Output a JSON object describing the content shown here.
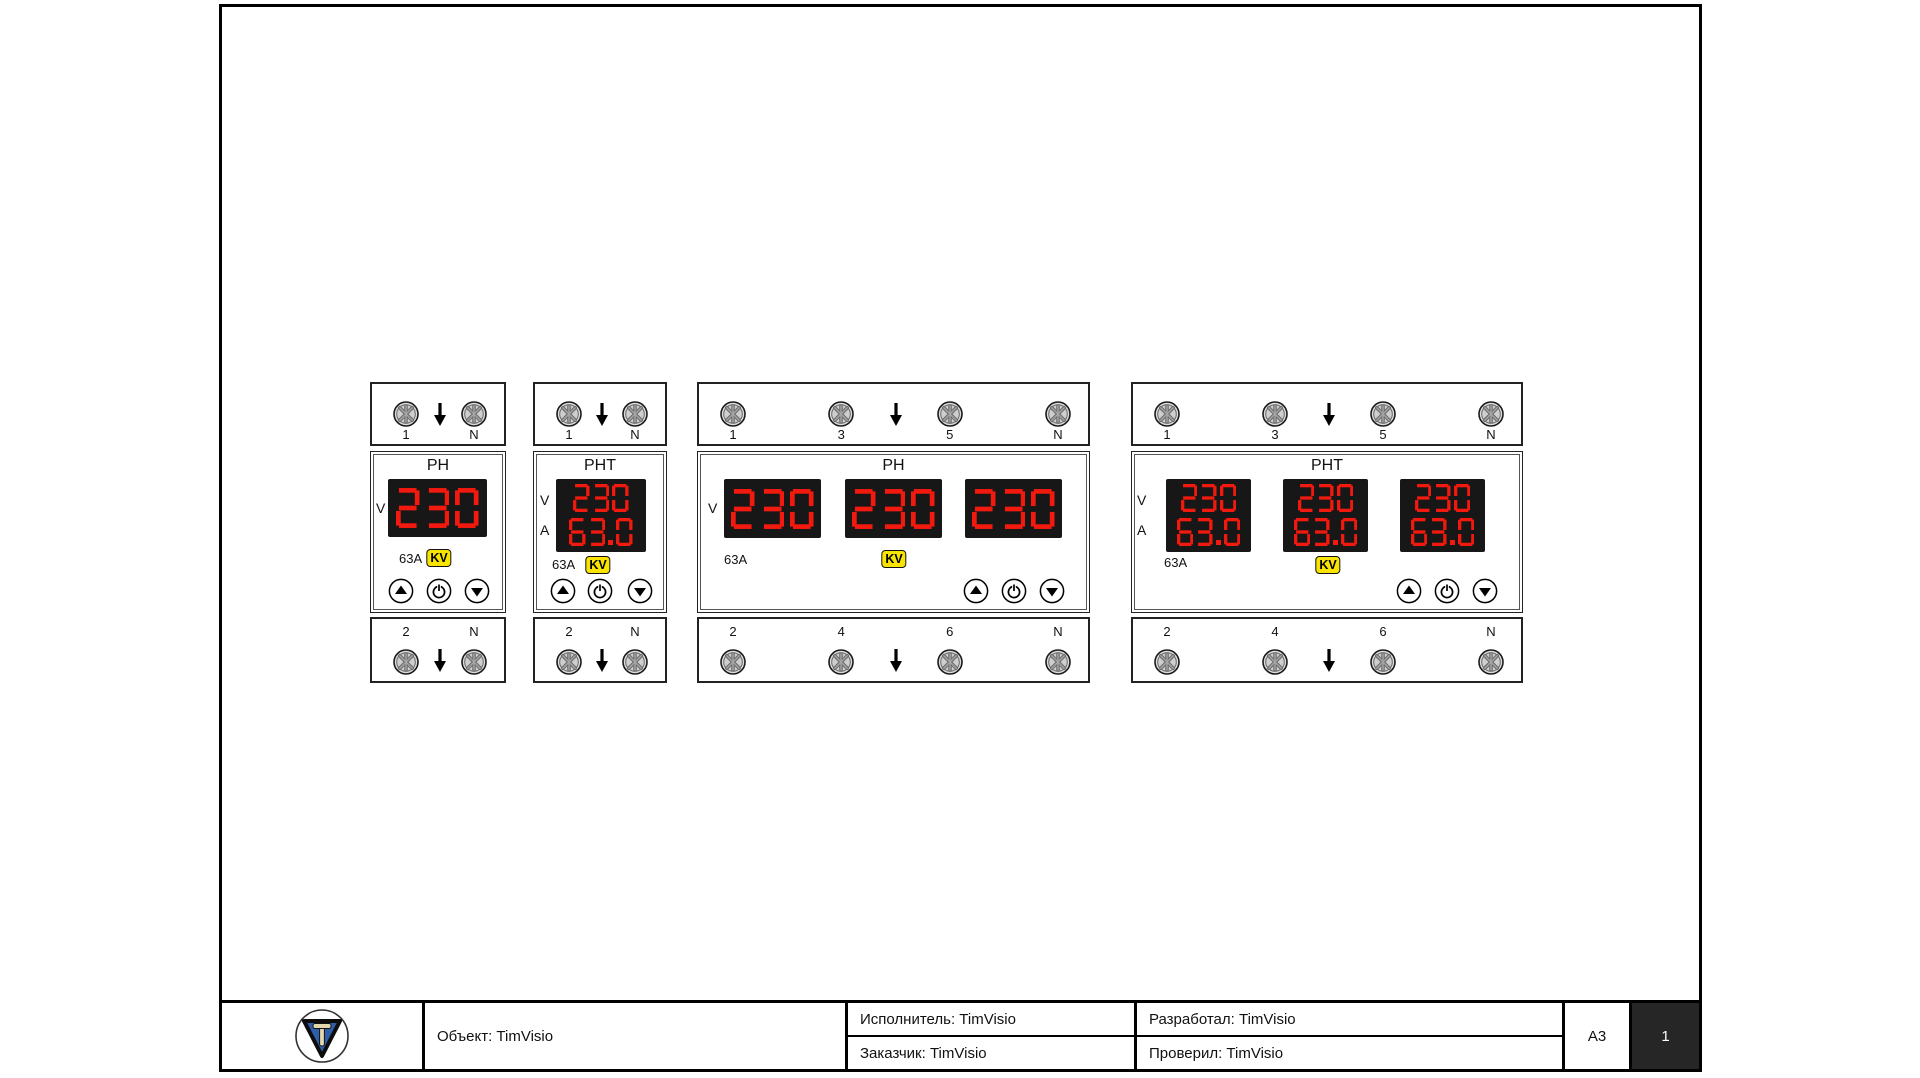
{
  "title_block": {
    "object": "Объект: TimVisio",
    "executor": "Исполнитель: TimVisio",
    "customer": "Заказчик: TimVisio",
    "developer": "Разработал: TimVisio",
    "checker": "Проверил: TimVisio",
    "format": "A3",
    "sheet_number": "1"
  },
  "devices": [
    {
      "id": "rn-single",
      "title": "РН",
      "top_terminals": [
        "1",
        "N"
      ],
      "bottom_terminals": [
        "2",
        "N"
      ],
      "side_labels": [
        "V"
      ],
      "displays": [
        [
          "230"
        ]
      ],
      "rating": "63A",
      "badge": "KV"
    },
    {
      "id": "rnt-single",
      "title": "РНТ",
      "top_terminals": [
        "1",
        "N"
      ],
      "bottom_terminals": [
        "2",
        "N"
      ],
      "side_labels": [
        "V",
        "A"
      ],
      "displays": [
        [
          "230",
          "63.0"
        ]
      ],
      "rating": "63A",
      "badge": "KV"
    },
    {
      "id": "rn-three",
      "title": "РН",
      "top_terminals": [
        "1",
        "3",
        "5",
        "N"
      ],
      "bottom_terminals": [
        "2",
        "4",
        "6",
        "N"
      ],
      "side_labels": [
        "V"
      ],
      "displays": [
        [
          "230"
        ],
        [
          "230"
        ],
        [
          "230"
        ]
      ],
      "rating": "63A",
      "badge": "KV"
    },
    {
      "id": "rnt-three",
      "title": "РНТ",
      "top_terminals": [
        "1",
        "3",
        "5",
        "N"
      ],
      "bottom_terminals": [
        "2",
        "4",
        "6",
        "N"
      ],
      "side_labels": [
        "V",
        "A"
      ],
      "displays": [
        [
          "230",
          "63.0"
        ],
        [
          "230",
          "63.0"
        ],
        [
          "230",
          "63.0"
        ]
      ],
      "rating": "63A",
      "badge": "KV"
    }
  ],
  "colors": {
    "digit_red": "#f2190f",
    "display_bg": "#171717",
    "badge_yellow": "#f8e400",
    "logo_blue": "#2f5ea8",
    "logo_letter_fill": "#e3d7ae",
    "sheet_cell_dark": "#262626"
  }
}
